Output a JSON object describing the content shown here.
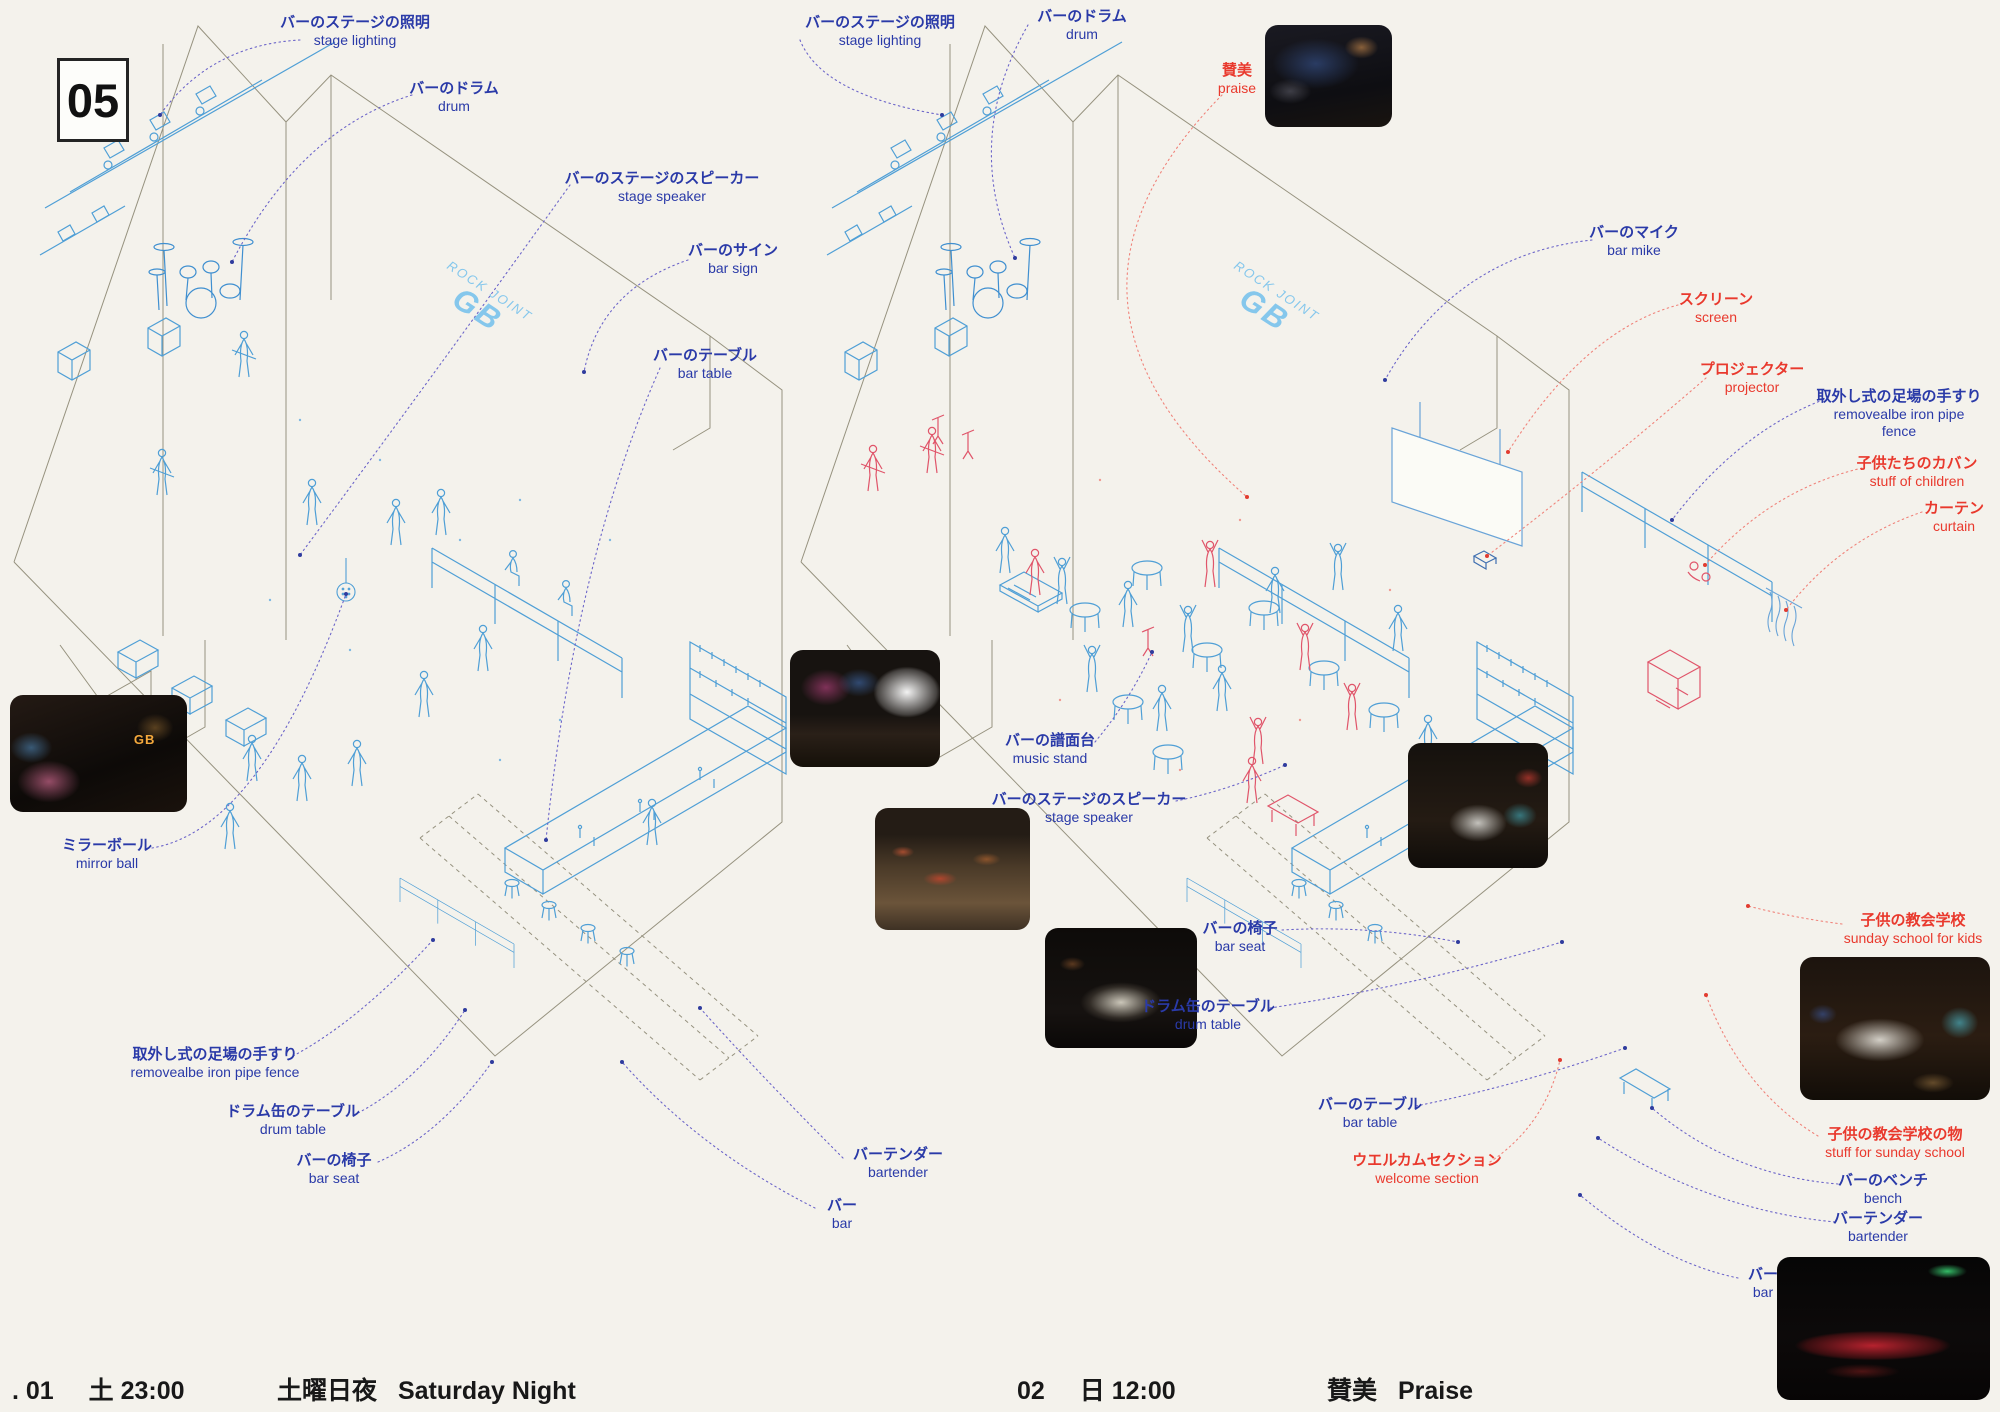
{
  "page": {
    "number": "05"
  },
  "wall_sign": {
    "line1": "ROCK JOINT",
    "line2": "GB"
  },
  "photos": {
    "left_stage_sign": "GB"
  },
  "captions": {
    "left": {
      "index": ". 01",
      "daytime": "土 23:00",
      "title_ja": "土曜日夜",
      "title_en": "Saturday Night"
    },
    "right": {
      "index": "02",
      "daytime": "日 12:00",
      "title_ja": "賛美",
      "title_en": "Praise"
    }
  },
  "colors": {
    "blue_label": "#2a3aa8",
    "red_label": "#e9392d",
    "blue_leader": "#6c65c9",
    "red_leader": "#f0837a",
    "figure_blue": "#4f9fd6",
    "figure_red": "#e0556a",
    "wall_line": "#96927f",
    "graffiti_blue": "#85c7ec"
  },
  "annotations": [
    {
      "id": "stage-lighting-l",
      "ja": "バーのステージの照明",
      "en": "stage lighting",
      "c": "b",
      "x": 355,
      "y": 14,
      "leader": [
        300,
        40,
        210,
        45,
        160,
        115
      ]
    },
    {
      "id": "drum-l",
      "ja": "バーのドラム",
      "en": "drum",
      "c": "b",
      "x": 454,
      "y": 80,
      "leader": [
        412,
        95,
        300,
        130,
        232,
        262
      ]
    },
    {
      "id": "stage-speaker-l",
      "ja": "バーのステージのスピーカー",
      "en": "stage speaker",
      "c": "b",
      "x": 662,
      "y": 170,
      "leader": [
        570,
        185,
        430,
        380,
        300,
        555
      ]
    },
    {
      "id": "bar-sign-l",
      "ja": "バーのサイン",
      "en": "bar sign",
      "c": "b",
      "x": 733,
      "y": 242,
      "leader": [
        688,
        260,
        600,
        290,
        584,
        372
      ]
    },
    {
      "id": "bar-table-l",
      "ja": "バーのテーブル",
      "en": "bar table",
      "c": "b",
      "x": 705,
      "y": 347,
      "leader": [
        660,
        368,
        575,
        560,
        546,
        840
      ]
    },
    {
      "id": "mirror-ball",
      "ja": "ミラーボール",
      "en": "mirror ball",
      "c": "b",
      "x": 107,
      "y": 837,
      "leader": [
        152,
        848,
        260,
        830,
        346,
        594
      ]
    },
    {
      "id": "fence-l",
      "ja": "取外し式の足場の手すり",
      "en": "removealbe iron pipe fence",
      "c": "b",
      "x": 215,
      "y": 1046,
      "leader": [
        293,
        1056,
        360,
        1020,
        433,
        940
      ]
    },
    {
      "id": "drum-table-l",
      "ja": "ドラム缶のテーブル",
      "en": "drum table",
      "c": "b",
      "x": 293,
      "y": 1103,
      "leader": [
        358,
        1113,
        420,
        1080,
        465,
        1010
      ]
    },
    {
      "id": "bar-seat-l",
      "ja": "バーの椅子",
      "en": "bar seat",
      "c": "b",
      "x": 334,
      "y": 1152,
      "leader": [
        378,
        1162,
        440,
        1135,
        492,
        1062
      ]
    },
    {
      "id": "bartender-l",
      "ja": "バーテンダー",
      "en": "bartender",
      "c": "b",
      "x": 898,
      "y": 1146,
      "leader": [
        843,
        1158,
        760,
        1075,
        700,
        1008
      ]
    },
    {
      "id": "bar-l",
      "ja": "バー",
      "en": "bar",
      "c": "b",
      "x": 842,
      "y": 1197,
      "leader": [
        815,
        1208,
        700,
        1150,
        622,
        1062
      ]
    },
    {
      "id": "stage-lighting-r",
      "ja": "バーのステージの照明",
      "en": "stage lighting",
      "c": "b",
      "x": 880,
      "y": 14,
      "leader": [
        800,
        40,
        822,
        95,
        942,
        115
      ]
    },
    {
      "id": "drum-r",
      "ja": "バーのドラム",
      "en": "drum",
      "c": "b",
      "x": 1082,
      "y": 8,
      "leader": [
        1028,
        25,
        962,
        140,
        1015,
        258
      ]
    },
    {
      "id": "praise",
      "ja": "賛美",
      "en": "praise",
      "c": "r",
      "x": 1237,
      "y": 62,
      "leader": [
        1222,
        95,
        1020,
        300,
        1247,
        497
      ]
    },
    {
      "id": "bar-mike",
      "ja": "バーのマイク",
      "en": "bar mike",
      "c": "b",
      "x": 1634,
      "y": 224,
      "leader": [
        1592,
        240,
        1455,
        255,
        1385,
        380
      ]
    },
    {
      "id": "screen",
      "ja": "スクリーン",
      "en": "screen",
      "c": "r",
      "x": 1716,
      "y": 291,
      "leader": [
        1678,
        305,
        1585,
        330,
        1508,
        452
      ]
    },
    {
      "id": "projector",
      "ja": "プロジェクター",
      "en": "projector",
      "c": "r",
      "x": 1752,
      "y": 361,
      "leader": [
        1706,
        378,
        1600,
        470,
        1487,
        556
      ]
    },
    {
      "id": "fence-r",
      "ja": "取外し式の足場の手すり",
      "en": "removealbe iron pipe",
      "en2": "fence",
      "c": "b",
      "x": 1899,
      "y": 388,
      "leader": [
        1828,
        398,
        1740,
        430,
        1672,
        520
      ]
    },
    {
      "id": "stuff-of-children",
      "ja": "子供たちのカバン",
      "en": "stuff of children",
      "c": "r",
      "x": 1917,
      "y": 455,
      "leader": [
        1862,
        468,
        1770,
        490,
        1705,
        565
      ]
    },
    {
      "id": "curtain",
      "ja": "カーテン",
      "en": "curtain",
      "c": "r",
      "x": 1954,
      "y": 500,
      "leader": [
        1922,
        512,
        1840,
        540,
        1786,
        610
      ]
    },
    {
      "id": "music-stand",
      "ja": "バーの譜面台",
      "en": "music stand",
      "c": "b",
      "x": 1050,
      "y": 732,
      "leader": [
        1095,
        742,
        1130,
        700,
        1152,
        652
      ]
    },
    {
      "id": "stage-speaker-r",
      "ja": "バーのステージのスピーカー",
      "en": "stage speaker",
      "c": "b",
      "x": 1089,
      "y": 791,
      "leader": [
        1176,
        801,
        1230,
        790,
        1285,
        765
      ]
    },
    {
      "id": "bar-seat-r",
      "ja": "バーの椅子",
      "en": "bar seat",
      "c": "b",
      "x": 1240,
      "y": 920,
      "leader": [
        1282,
        930,
        1370,
        925,
        1458,
        942
      ]
    },
    {
      "id": "drum-table-r",
      "ja": "ドラム缶のテーブル",
      "en": "drum table",
      "c": "b",
      "x": 1208,
      "y": 998,
      "leader": [
        1270,
        1008,
        1420,
        985,
        1562,
        942
      ]
    },
    {
      "id": "bar-table-r",
      "ja": "バーのテーブル",
      "en": "bar table",
      "c": "b",
      "x": 1370,
      "y": 1096,
      "leader": [
        1416,
        1106,
        1520,
        1085,
        1625,
        1048
      ]
    },
    {
      "id": "welcome-section",
      "ja": "ウエルカムセクション",
      "en": "welcome section",
      "c": "r",
      "x": 1427,
      "y": 1152,
      "leader": [
        1490,
        1162,
        1545,
        1125,
        1560,
        1060
      ]
    },
    {
      "id": "sunday-school",
      "ja": "子供の教会学校",
      "en": "sunday school for kids",
      "c": "r",
      "x": 1913,
      "y": 912,
      "leader": [
        1842,
        924,
        1795,
        918,
        1748,
        906
      ]
    },
    {
      "id": "stuff-for-sunday-school",
      "ja": "子供の教会学校の物",
      "en": "stuff for sunday school",
      "c": "r",
      "x": 1895,
      "y": 1126,
      "leader": [
        1818,
        1136,
        1742,
        1090,
        1706,
        995
      ]
    },
    {
      "id": "bench",
      "ja": "バーのベンチ",
      "en": "bench",
      "c": "b",
      "x": 1883,
      "y": 1172,
      "leader": [
        1838,
        1184,
        1730,
        1175,
        1652,
        1108
      ]
    },
    {
      "id": "bartender-r",
      "ja": "バーテンダー",
      "en": "bartender",
      "c": "b",
      "x": 1878,
      "y": 1210,
      "leader": [
        1835,
        1222,
        1710,
        1210,
        1598,
        1138
      ]
    },
    {
      "id": "bar-r",
      "ja": "バー",
      "en": "bar",
      "c": "b",
      "x": 1763,
      "y": 1266,
      "leader": [
        1738,
        1278,
        1660,
        1262,
        1580,
        1195
      ]
    }
  ]
}
